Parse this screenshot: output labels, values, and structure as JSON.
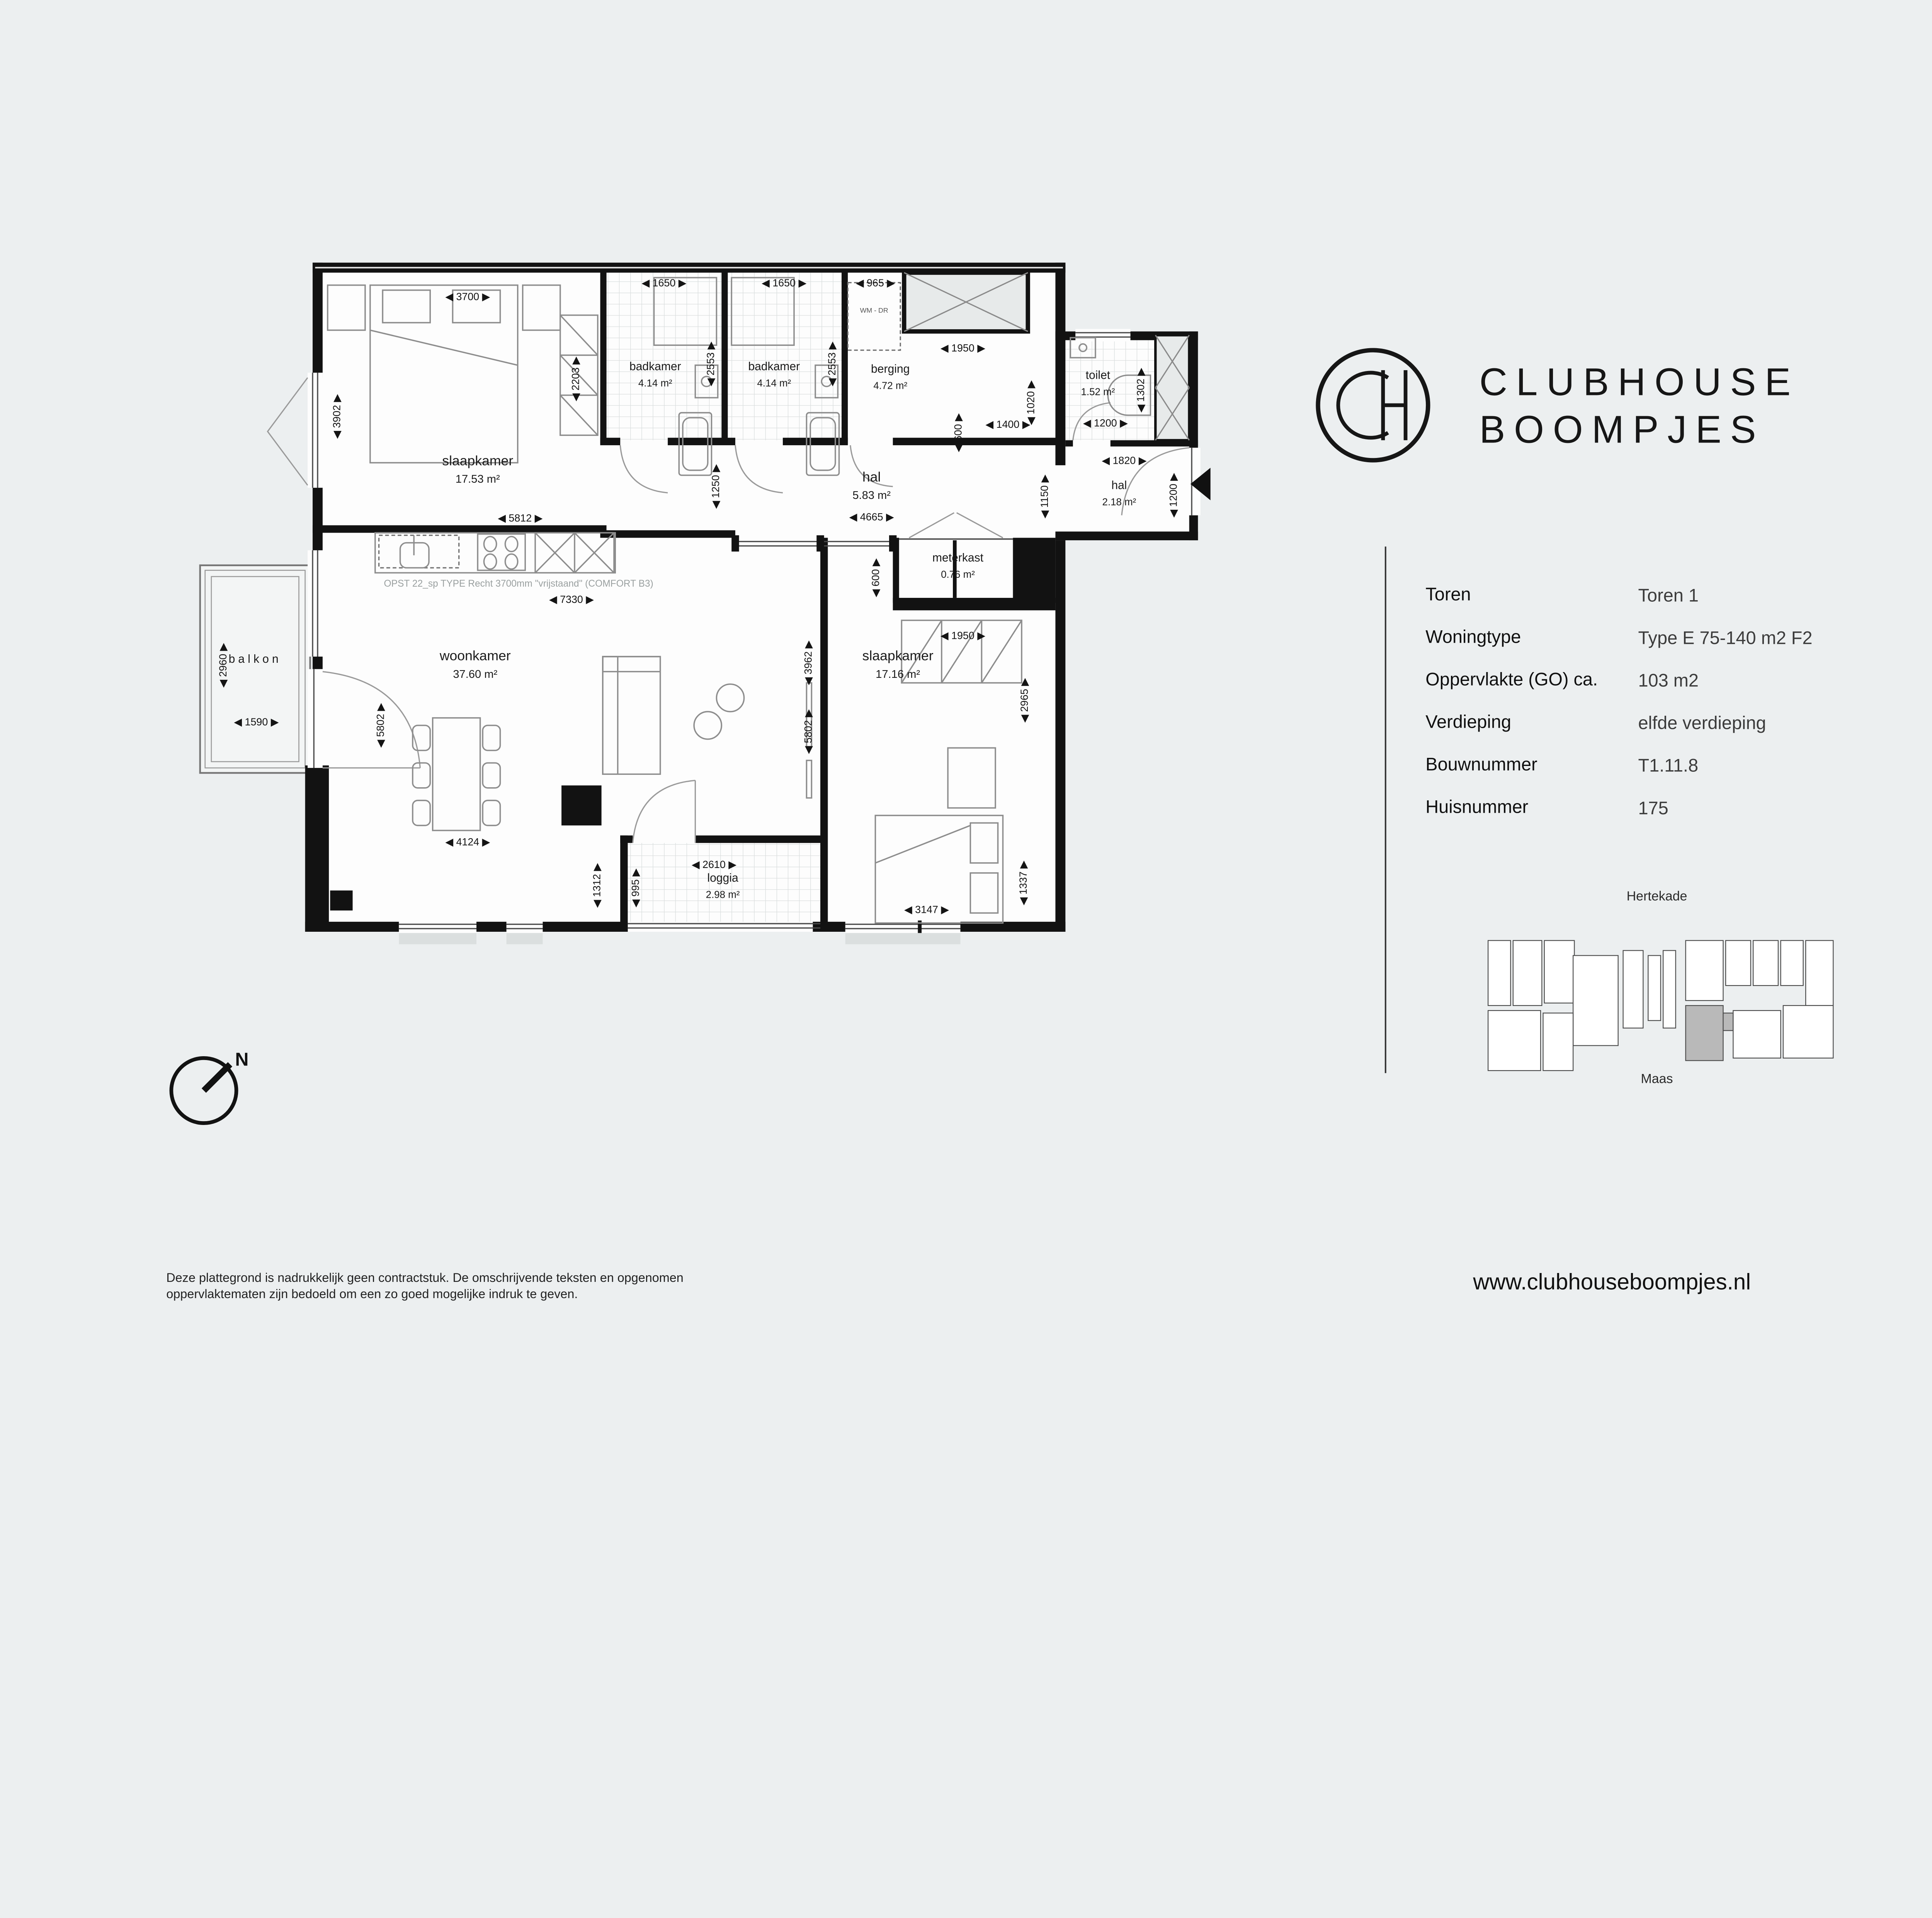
{
  "brand": {
    "monogram": "CH",
    "name_line1": "CLUBHOUSE",
    "name_line2": "BOOMPJES"
  },
  "info_panel": {
    "rows": [
      {
        "label": "Toren",
        "value": "Toren 1"
      },
      {
        "label": "Woningtype",
        "value": "Type E 75-140 m2 F2"
      },
      {
        "label": "Oppervlakte (GO) ca.",
        "value": "103 m2"
      },
      {
        "label": "Verdieping",
        "value": "elfde verdieping"
      },
      {
        "label": "Bouwnummer",
        "value": "T1.11.8"
      },
      {
        "label": "Huisnummer",
        "value": "175"
      }
    ]
  },
  "site_map": {
    "street_top": "Hertekade",
    "street_bottom": "Maas"
  },
  "compass": {
    "north": "N"
  },
  "plan": {
    "kitchen_note": "OPST 22_sp  TYPE Recht 3700mm \"vrijstaand\" (COMFORT B3)",
    "appliance_label": "WM - DR",
    "rooms": {
      "slaapkamer1": {
        "name": "slaapkamer",
        "area": "17.53 m²"
      },
      "badkamer1": {
        "name": "badkamer",
        "area": "4.14 m²"
      },
      "badkamer2": {
        "name": "badkamer",
        "area": "4.14 m²"
      },
      "berging": {
        "name": "berging",
        "area": "4.72 m²"
      },
      "toilet": {
        "name": "toilet",
        "area": "1.52 m²"
      },
      "hal": {
        "name": "hal",
        "area": "5.83 m²"
      },
      "hal2": {
        "name": "hal",
        "area": "2.18 m²"
      },
      "meterkast": {
        "name": "meterkast",
        "area": "0.76 m²"
      },
      "woonkamer": {
        "name": "woonkamer",
        "area": "37.60 m²"
      },
      "slaapkamer2": {
        "name": "slaapkamer",
        "area": "17.16 m²"
      },
      "loggia": {
        "name": "loggia",
        "area": "2.98 m²"
      },
      "balkon": {
        "name": "balkon"
      }
    },
    "dims": {
      "d3700": "◀ 3700 ▶",
      "d1650a": "◀ 1650 ▶",
      "d1650b": "◀ 1650 ▶",
      "d965": "◀ 965 ▶",
      "d1950a": "◀ 1950 ▶",
      "d1400": "◀ 1400 ▶",
      "d1200a": "◀ 1200 ▶",
      "d1820": "◀ 1820 ▶",
      "d5812": "◀ 5812 ▶",
      "d4665": "◀ 4665 ▶",
      "d7330": "◀ 7330 ▶",
      "d1950b": "◀ 1950 ▶",
      "d1590": "◀ 1590 ▶",
      "d4124": "◀ 4124 ▶",
      "d2610": "◀ 2610 ▶",
      "d3147": "◀ 3147 ▶",
      "d3902": "◀ 3902 ▶",
      "d2203": "◀ 2203 ▶",
      "d2553a": "◀ 2553 ▶",
      "d2553b": "◀ 2553 ▶",
      "d1250": "◀ 1250 ▶",
      "d1020": "◀ 1020 ▶",
      "d1302": "◀ 1302 ▶",
      "d1150": "◀ 1150 ▶",
      "d1200b": "◀ 1200 ▶",
      "d600a": "◀ 600 ▶",
      "d600b": "◀ 600 ▶",
      "d3962": "◀ 3962 ▶",
      "d5802a": "◀ 5802 ▶",
      "d5802b": "◀ 5802 ▶",
      "d2960": "◀ 2960 ▶",
      "d1312": "◀ 1312 ▶",
      "d995": "◀ 995 ▶",
      "d2965": "◀ 2965 ▶",
      "d1337": "◀ 1337 ▶"
    }
  },
  "footer": {
    "disclaimer_line1": "Deze plattegrond is nadrukkelijk geen contractstuk. De omschrijvende teksten en opgenomen",
    "disclaimer_line2": "oppervlaktematen zijn bedoeld om een zo goed mogelijke indruk te geven.",
    "website": "www.clubhouseboompjes.nl"
  }
}
